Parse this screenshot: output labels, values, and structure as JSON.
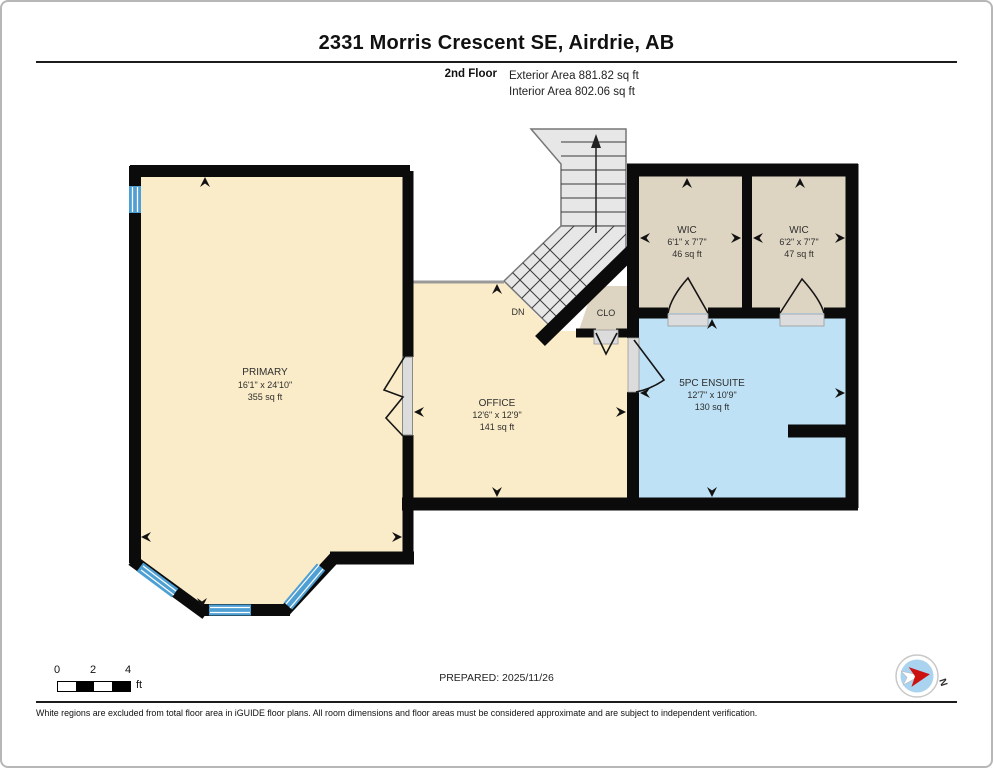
{
  "header": {
    "title": "2331 Morris Crescent SE, Airdrie, AB",
    "floor_label": "2nd Floor",
    "exterior_area": "Exterior Area 881.82 sq ft",
    "interior_area": "Interior Area 802.06 sq ft"
  },
  "rooms": {
    "primary": {
      "name": "PRIMARY",
      "dimensions": "16'1\" x 24'10\"",
      "area": "355 sq ft"
    },
    "office": {
      "name": "OFFICE",
      "dimensions": "12'6\" x 12'9\"",
      "area": "141 sq ft"
    },
    "wic1": {
      "name": "WIC",
      "dimensions": "6'1\" x 7'7\"",
      "area": "46 sq ft"
    },
    "wic2": {
      "name": "WIC",
      "dimensions": "6'2\" x 7'7\"",
      "area": "47 sq ft"
    },
    "ensuite": {
      "name": "5PC ENSUITE",
      "dimensions": "12'7\" x 10'9\"",
      "area": "130 sq ft"
    },
    "closet": {
      "name": "CLO"
    },
    "stairs": {
      "label": "DN"
    }
  },
  "scale_bar": {
    "tick_0": "0",
    "tick_2": "2",
    "tick_4": "4",
    "unit": "ft"
  },
  "footer": {
    "prepared": "PREPARED: 2025/11/26",
    "compass_north": "N",
    "disclaimer": "White regions are excluded from total floor area in iGUIDE floor plans. All room dimensions and floor areas must be considered approximate and are subject to independent verification."
  },
  "colors": {
    "floor_primary": "#FAECC8",
    "floor_closet": "#DED4C2",
    "floor_ensuite": "#BEE1F5",
    "window": "#4E9FD4",
    "wall": "#0B0B0B",
    "stairs": "#E7E7E7"
  }
}
